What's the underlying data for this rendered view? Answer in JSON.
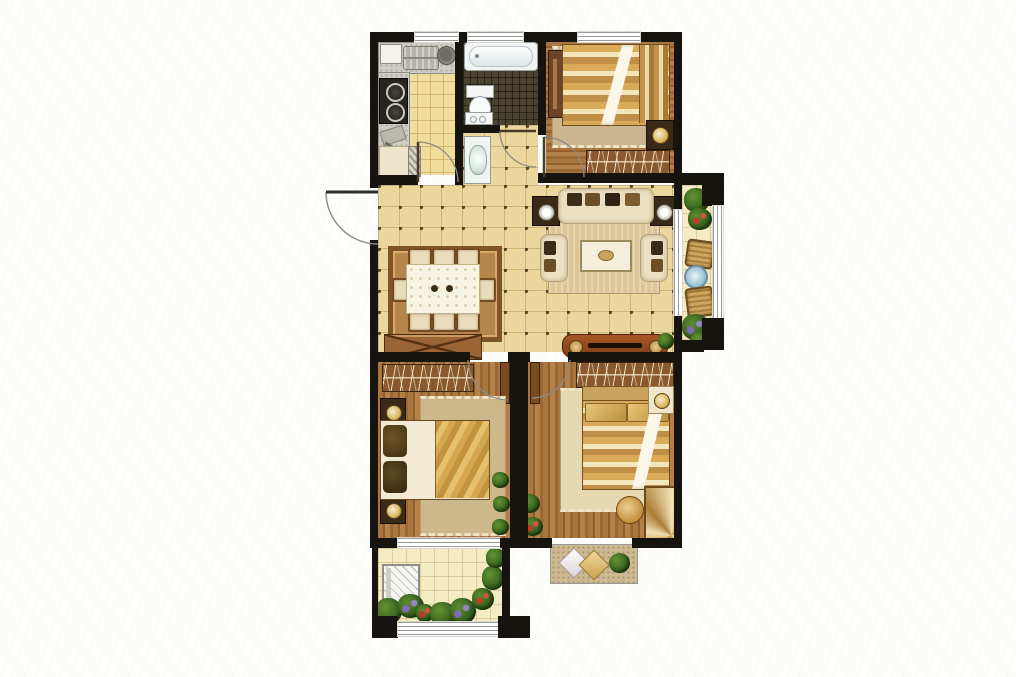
{
  "image_type": "residential floor plan, rendered top-down color architectural drawing, no text labels",
  "background": "white with very faint diagonal texture",
  "palette": {
    "wall": "#17130e",
    "living_tile": "#ebd79e",
    "kitchen_tile": "#f1dd9b",
    "balcony_tile": "#f6ecc3",
    "bathroom_mosaic": "#49422f",
    "wood_floor": "#a06c38",
    "gold_fabric": "#d4a750",
    "cream_fabric": "#ece0c2",
    "tv_cabinet": "#9a4f24",
    "plant_green": "#3c6a1e",
    "window_glass": "#ffffff"
  },
  "rooms": [
    {
      "id": "kitchen",
      "position": "top-left",
      "floor": "yellow tile grid",
      "furniture": [
        "counter with double sink",
        "round pot",
        "gas stove two burners",
        "cutting board",
        "refrigerator",
        "door with swing arc"
      ]
    },
    {
      "id": "bathroom",
      "position": "top-center",
      "floor": "dark mosaic",
      "furniture": [
        "bathtub",
        "toilet",
        "low cabinet",
        "door with swing arc"
      ]
    },
    {
      "id": "hallway-vestibule",
      "position": "center, below bathroom",
      "floor": "beige tile",
      "furniture": [
        "washbasin vanity"
      ]
    },
    {
      "id": "bedroom-top-right",
      "position": "top-right",
      "floor": "wood plank",
      "furniture": [
        "double bed gold striped with white throw",
        "side cabinet on left wall",
        "nightstand with round lamp",
        "wardrobe with hangers",
        "area rug with tassels",
        "window on top wall",
        "door with swing arc"
      ]
    },
    {
      "id": "living-dining-room",
      "position": "center",
      "floor": "beige tile with dark dots",
      "furniture": [
        "entry door with outward swing arc",
        "dining rug",
        "dining table with white cloth",
        "six dining chairs",
        "sideboard with X front",
        "three-seat sofa with dark pillows",
        "two armchairs",
        "two dark end tables with round lamps",
        "coffee table",
        "living rug",
        "tv cabinet with speakers",
        "small plant"
      ]
    },
    {
      "id": "balcony-right",
      "position": "right of living room",
      "floor": "pale tile grid",
      "furniture": [
        "potted plants top",
        "two wicker stools",
        "small round blue table",
        "flowering plants bottom",
        "full-height window on right",
        "sliding door to living room"
      ]
    },
    {
      "id": "bedroom-bottom-left",
      "position": "bottom-left",
      "floor": "wood plank",
      "furniture": [
        "double bed with dark pillows and gold blanket",
        "two nightstands with round lamps",
        "wardrobe with hangers",
        "area rug",
        "three potted plants",
        "door with swing arc",
        "window to balcony"
      ]
    },
    {
      "id": "bedroom-bottom-right",
      "position": "bottom-right",
      "floor": "wood plank",
      "furniture": [
        "double bed gold striped with white throw",
        "headboard",
        "nightstand with round lamp",
        "wardrobe with hangers",
        "area rug",
        "fan-pattern chaise",
        "round gold ottoman",
        "two potted plants",
        "bay window seat with two diamond cushions and plant",
        "door with swing arc"
      ]
    },
    {
      "id": "balcony-bottom-left",
      "position": "bottom-left below bedroom",
      "floor": "pale tile grid",
      "furniture": [
        "washing machine",
        "flower planters green red purple",
        "wrap-around windows"
      ]
    }
  ],
  "doors": [
    "entry door opens outward on left wall",
    "kitchen door",
    "bathroom door",
    "three bedroom doors with quarter-circle arcs"
  ],
  "windows": [
    "kitchen top",
    "bathroom top",
    "bedroom top-right top",
    "right balcony glazing",
    "bedroom-to-balcony bottom-left",
    "bay window bottom-right",
    "balcony bottom glazing"
  ]
}
